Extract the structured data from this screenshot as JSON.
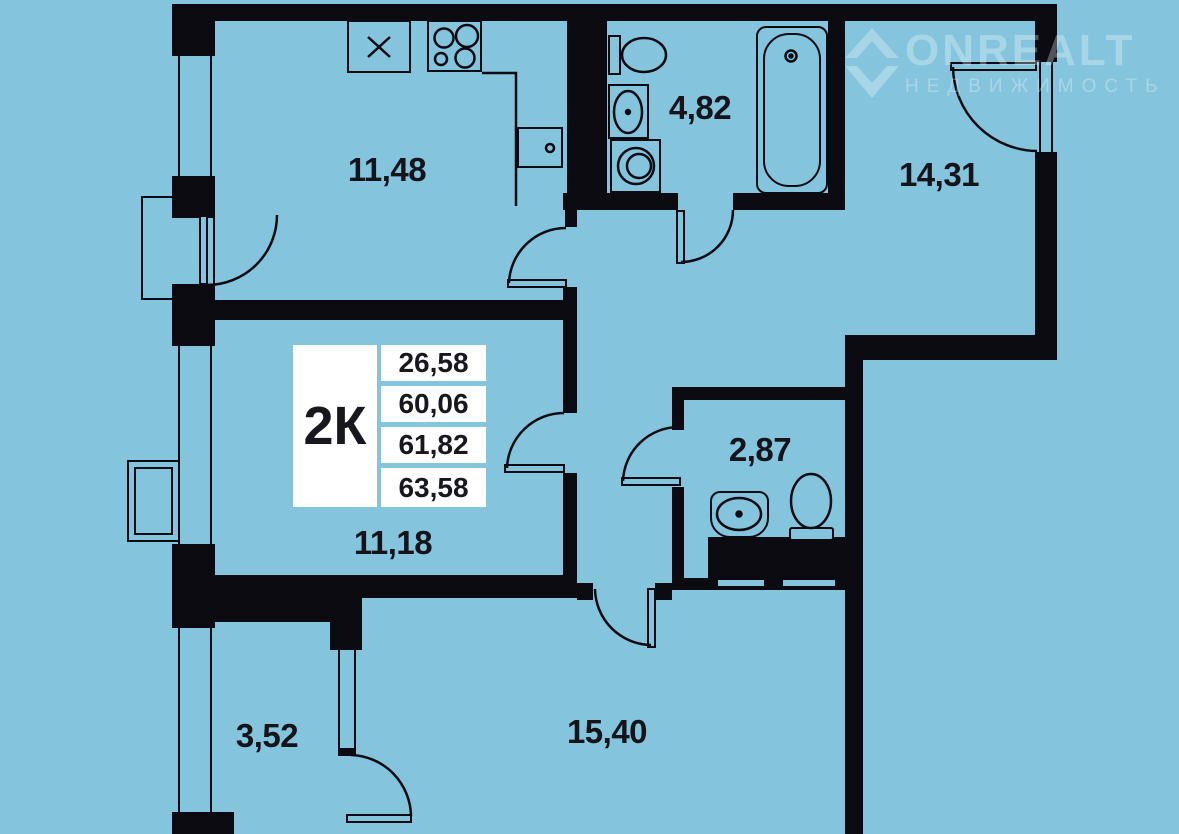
{
  "watermark": {
    "brand": "ONREALT",
    "subtitle": "НЕДВИЖИМОСТЬ"
  },
  "unit_card": {
    "type_label": "2К",
    "values": [
      "26,58",
      "60,06",
      "61,82",
      "63,58"
    ]
  },
  "rooms": {
    "kitchen": {
      "area": "11,48"
    },
    "bathroom": {
      "area": "4,82"
    },
    "bedroom_right": {
      "area": "14,31"
    },
    "wc": {
      "area": "2,87"
    },
    "bedroom_left": {
      "area": "11,18"
    },
    "balcony": {
      "area": "3,52"
    },
    "living_room": {
      "area": "15,40"
    }
  },
  "colors": {
    "background": "#84c4dd",
    "walls": "#0b0b11",
    "label_text": "#14141a",
    "card_bg": "#ffffff",
    "watermark": "rgba(255,255,255,0.30)"
  }
}
